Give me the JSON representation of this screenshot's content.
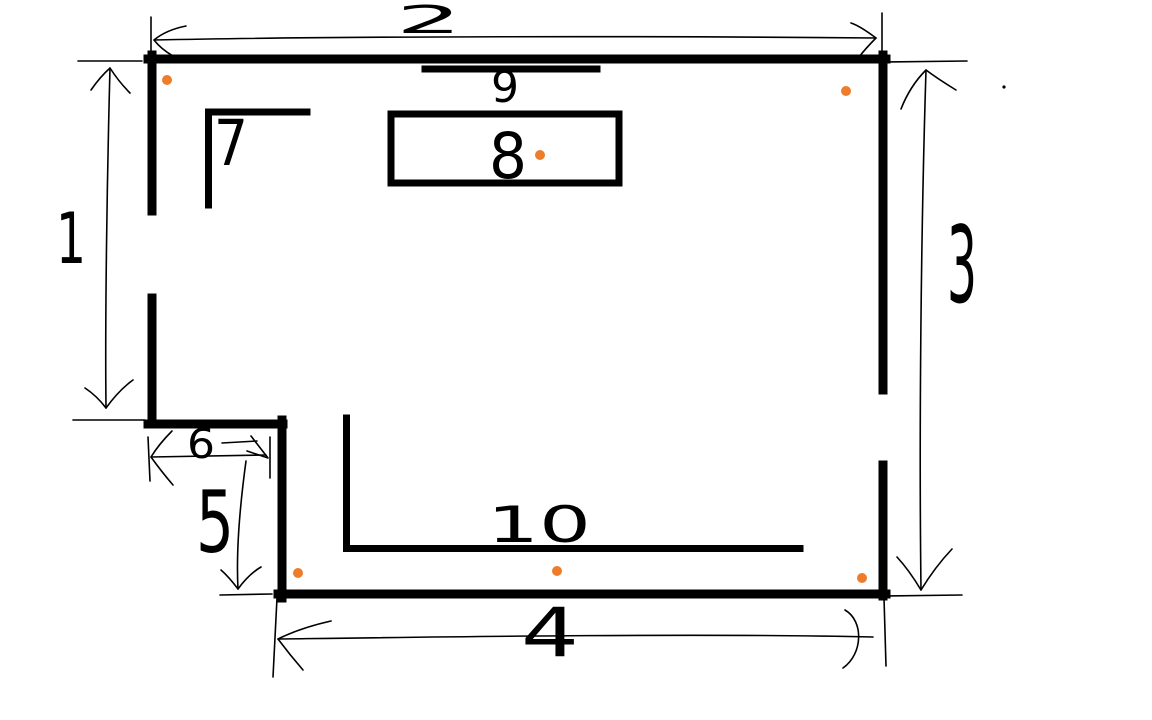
{
  "canvas": {
    "width": 1152,
    "height": 720,
    "background": "#ffffff",
    "ink_color": "#000000",
    "dot_color": "#EE7D2B"
  },
  "annotations": {
    "labels": [
      {
        "id": "left-height-1",
        "text": "1",
        "x": 56,
        "y": 263,
        "size": 70,
        "stretch": 30
      },
      {
        "id": "top-width-2",
        "text": "2",
        "x": 396,
        "y": 33,
        "size": 38,
        "stretch": 66
      },
      {
        "id": "right-height-3",
        "text": "3",
        "x": 947,
        "y": 302,
        "size": 106,
        "stretch": 30
      },
      {
        "id": "bottom-width-4",
        "text": "4",
        "x": 521,
        "y": 656,
        "size": 68,
        "stretch": 58
      },
      {
        "id": "step-height-5",
        "text": "5",
        "x": 196,
        "y": 552,
        "size": 86,
        "stretch": 38
      },
      {
        "id": "step-width-6",
        "text": "6",
        "x": 187,
        "y": 458,
        "size": 41,
        "stretch": 28
      },
      {
        "id": "corner-wall-7",
        "text": "7",
        "x": 214,
        "y": 165,
        "size": 63,
        "stretch": 34
      },
      {
        "id": "table-8",
        "text": "8",
        "x": 489,
        "y": 178,
        "size": 63,
        "stretch": 38
      },
      {
        "id": "top-line-9",
        "text": "9",
        "x": 491,
        "y": 102,
        "size": 44,
        "stretch": 28
      },
      {
        "id": "bottom-inner-wall-10",
        "text": "10",
        "x": 487,
        "y": 542,
        "size": 50,
        "stretch": 104
      }
    ],
    "dots": [
      {
        "x": 167,
        "y": 80
      },
      {
        "x": 846,
        "y": 91
      },
      {
        "x": 540,
        "y": 155
      },
      {
        "x": 298,
        "y": 573
      },
      {
        "x": 557,
        "y": 571
      },
      {
        "x": 862,
        "y": 578
      }
    ],
    "stray_dot": {
      "x": 1004,
      "y": 87
    }
  }
}
